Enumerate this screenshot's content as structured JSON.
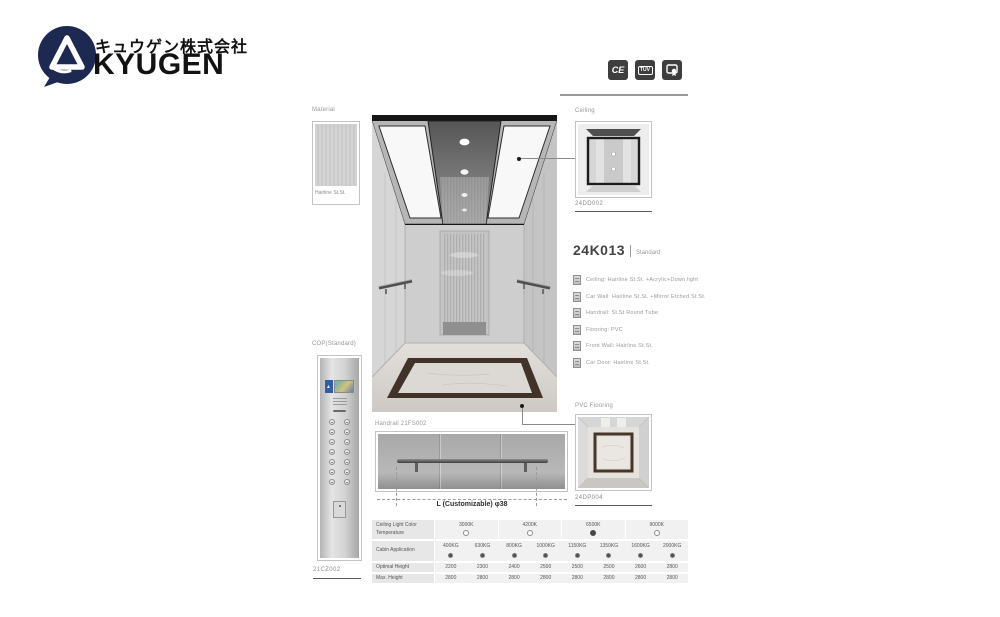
{
  "brand": {
    "jp_name": "キュウゲン株式会社",
    "en_name": "KYUGEN"
  },
  "certifications": {
    "ce": "CE",
    "tuv": "TÜV"
  },
  "material": {
    "label": "Material",
    "caption": "Hairline St.St."
  },
  "ceiling_detail": {
    "label": "Ceiling",
    "code": "24DD002"
  },
  "model": {
    "code": "24K013",
    "variant": "Standard",
    "specs": [
      "Ceiling: Hairline St.St. +Acrylic+Down light",
      "Car Wall: Hairline St.St. +Mirror Etched St.St.",
      "Handrail: St.St Round Tube",
      "Flooring: PVC",
      "Front Wall: Hairline St.St.",
      "Car Door: Hairline St.St."
    ]
  },
  "pvc_flooring": {
    "label": "PVC Flooring",
    "code": "24DP004"
  },
  "cop": {
    "label": "COP(Standard)",
    "code": "21CZ002"
  },
  "handrail": {
    "label": "Handrail 21FS002",
    "dimension": "L (Customizable)  φ38"
  },
  "table": {
    "rows": [
      {
        "label": "Ceiling Light Color Temperature",
        "type": "radio-group",
        "options": [
          {
            "value": "3000K",
            "selected": false
          },
          {
            "value": "4200K",
            "selected": false
          },
          {
            "value": "6500K",
            "selected": true
          },
          {
            "value": "9000K",
            "selected": false
          }
        ]
      },
      {
        "label": "Cabin Application",
        "type": "dot-group",
        "options": [
          {
            "value": "400KG",
            "selected": true
          },
          {
            "value": "630KG",
            "selected": true
          },
          {
            "value": "800KG",
            "selected": true
          },
          {
            "value": "1000KG",
            "selected": true
          },
          {
            "value": "1150KG",
            "selected": true
          },
          {
            "value": "1350KG",
            "selected": true
          },
          {
            "value": "1600KG",
            "selected": true
          },
          {
            "value": "2000KG",
            "selected": true
          }
        ]
      },
      {
        "label": "Optimal Height",
        "values": [
          "2200",
          "2300",
          "2400",
          "2500",
          "2500",
          "2500",
          "2600",
          "2800"
        ]
      },
      {
        "label": "Max. Height",
        "values": [
          "2800",
          "2800",
          "2800",
          "2800",
          "2800",
          "2800",
          "2800",
          "2800"
        ]
      }
    ]
  }
}
